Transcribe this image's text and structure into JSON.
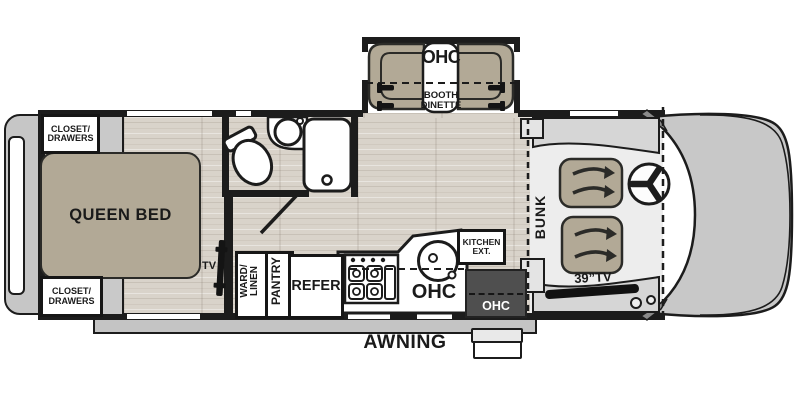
{
  "colors": {
    "wall": "#1c1c1c",
    "furniture_tan": "#b2a996",
    "floor_wood": "#d9d3ca",
    "exterior_gray": "#c6c6c6",
    "cab_floor": "#ededed",
    "dark_cabinet": "#4f4f4f",
    "fixture_white": "#ffffff"
  },
  "bedroom": {
    "closet_top": "CLOSET/\nDRAWERS",
    "closet_bottom": "CLOSET/\nDRAWERS",
    "bed": "QUEEN BED",
    "tv": "TV"
  },
  "bathroom": {
    "fixtures": [
      "toilet",
      "sink-vanity",
      "shower",
      "door-swing"
    ]
  },
  "dinette": {
    "ohc": "OHC",
    "booth": "BOOTH\nDINETTE",
    "fixtures": [
      "bench-seat-left",
      "bench-seat-right",
      "table",
      "seat-belts",
      "slide-out"
    ]
  },
  "kitchen": {
    "ward_linen": "WARD/\nLINEN",
    "pantry": "PANTRY",
    "refer": "REFER",
    "ohc": "OHC",
    "kitchen_ext": "KITCHEN\nEXT.",
    "entry_ohc": "OHC",
    "fixtures": [
      "range-stove",
      "round-sink",
      "counter",
      "entry-steps"
    ]
  },
  "cab": {
    "bunk": "BUNK",
    "tv": "39”TV",
    "fixtures": [
      "driver-seat",
      "passenger-seat",
      "steering-wheel",
      "dashboard",
      "truck-hood",
      "cab-over-line"
    ]
  },
  "exterior": {
    "awning": "AWNING",
    "fixtures": [
      "awning-rail",
      "rear-cap",
      "rear-window"
    ]
  }
}
